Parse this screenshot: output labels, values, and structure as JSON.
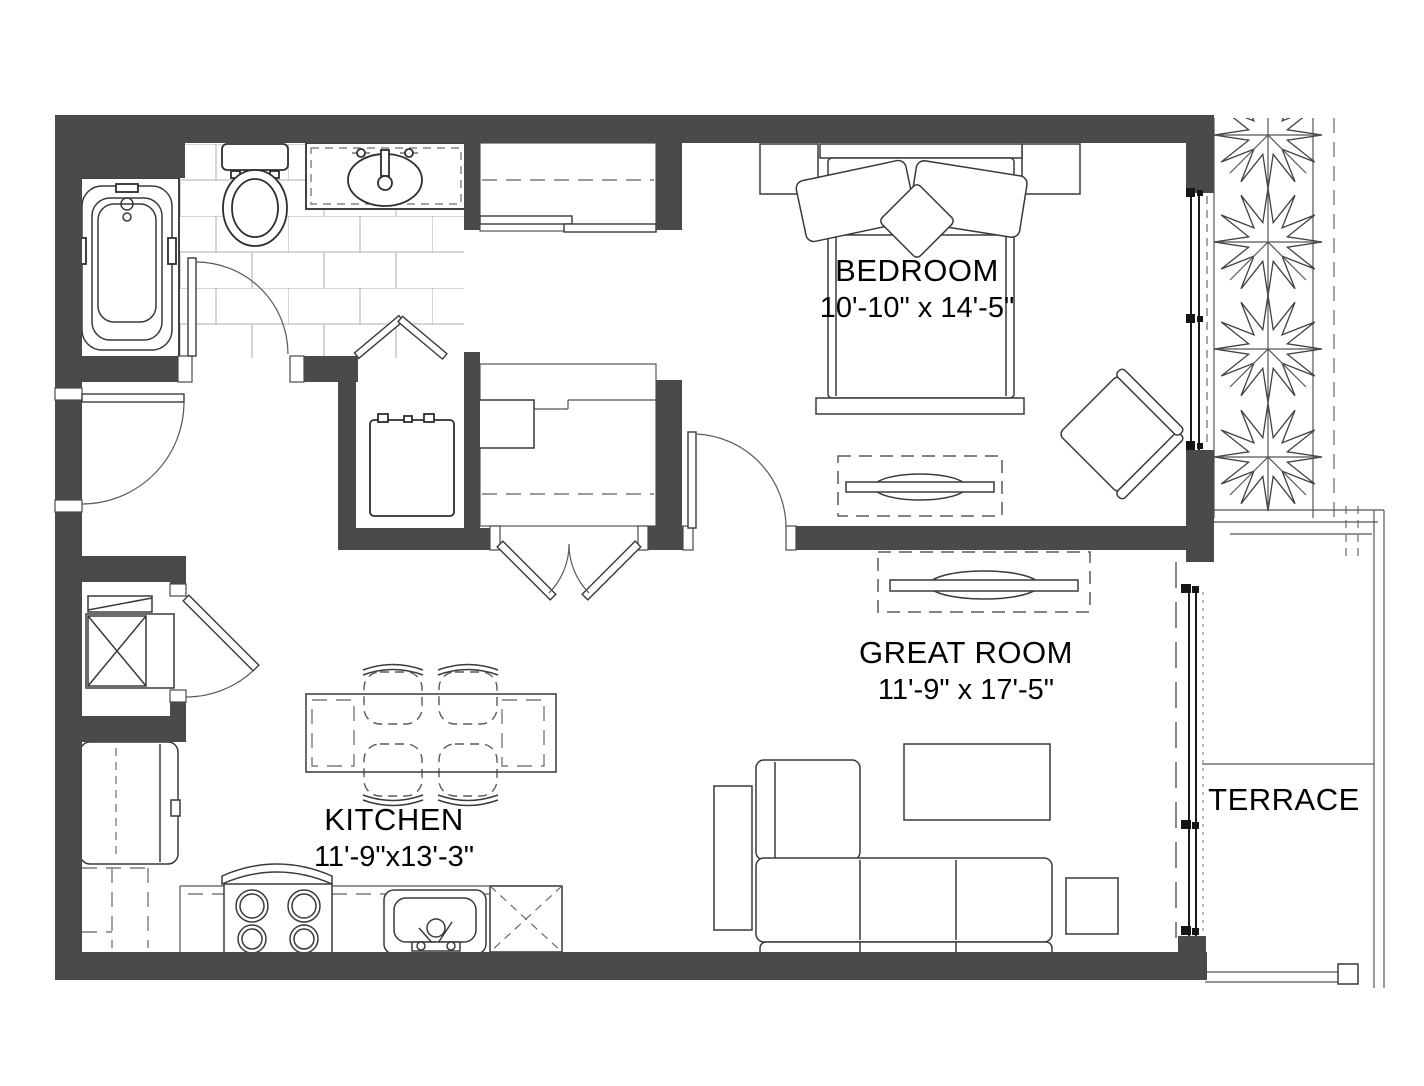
{
  "plan": {
    "rooms": [
      {
        "name": "BEDROOM",
        "dims": "10'-10\" x 14'-5\""
      },
      {
        "name": "GREAT ROOM",
        "dims": "11'-9\" x 17'-5\""
      },
      {
        "name": "KITCHEN",
        "dims": "11'-9\"x13'-3\""
      },
      {
        "name": "TERRACE",
        "dims": ""
      }
    ],
    "colors": {
      "wall": "#4a4a4a",
      "line": "#2e2e2e",
      "furniture": "#3a3a3a",
      "tile": "#c9c9c9",
      "background": "#ffffff"
    },
    "fixtures": [
      "bathtub",
      "toilet",
      "vanity-sink",
      "bathroom-door",
      "entry-door",
      "sliding-door-closet",
      "shelf-closet",
      "water-heater",
      "bifold-door",
      "washer-dryer",
      "utility-door",
      "french-closet-doors",
      "bedroom-door",
      "bed",
      "pillows",
      "nightstands",
      "dresser-with-tv",
      "armchair",
      "bedroom-window",
      "terrace-sliding-door",
      "planter-shrubs",
      "media-console-with-tv",
      "sectional-sofa",
      "coffee-table",
      "side-table",
      "console-table",
      "dining-table",
      "dining-chairs",
      "refrigerator",
      "range",
      "kitchen-sink",
      "dishwasher",
      "kitchen-counter",
      "terrace-railing"
    ]
  }
}
